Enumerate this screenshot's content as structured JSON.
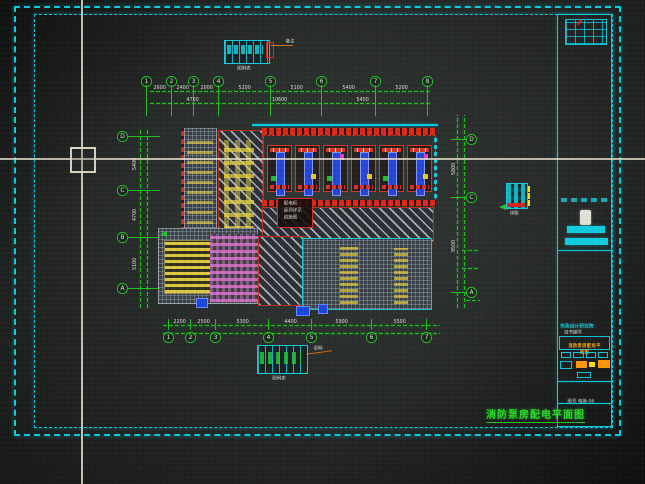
{
  "app": {
    "kind": "CAD drawing viewport photo",
    "background": "#272b29",
    "frame_color": "#00d2e6",
    "dim_color": "#1ec41e"
  },
  "drawing_title": {
    "text": "消防泵房配电平面图"
  },
  "axes": {
    "top": {
      "bubbles": [
        "1",
        "2",
        "3",
        "4",
        "5",
        "6",
        "7",
        "8"
      ],
      "dims": [
        "2600",
        "2400",
        "2000",
        "5200",
        "5100",
        "5400",
        "5200"
      ],
      "dims2": [
        "4700",
        "10600",
        "5400"
      ]
    },
    "bottom": {
      "bubbles": [
        "1",
        "2",
        "3",
        "4",
        "5",
        "6",
        "7"
      ],
      "dims": [
        "2200",
        "2500",
        "5300",
        "4400",
        "5900",
        "5500"
      ]
    },
    "left": {
      "bubbles": [
        "D",
        "C",
        "B",
        "A"
      ],
      "dims": [
        "5400",
        "4700",
        "5100"
      ]
    },
    "right": {
      "bubbles": [
        "D",
        "C",
        "A"
      ],
      "dims": [
        "5800",
        "9500"
      ]
    }
  },
  "plan": {
    "equipment_bays": 6,
    "note_box_lines": [
      "配电柜",
      "留洞详见",
      "结施图"
    ]
  },
  "legends": {
    "top": {
      "label": "图例表",
      "note": "备注"
    },
    "bottom": {
      "label": "图例表",
      "note": "说明"
    },
    "detail": {
      "label": "详图"
    }
  },
  "title_block": {
    "firm": "市政设计研究院",
    "cert": "证书编号",
    "rows": [
      {
        "label": "审定",
        "value": "2016",
        "color": "#20e020"
      },
      {
        "label": "审核",
        "value": "初设",
        "color": "#ff30ff"
      },
      {
        "label": "总工",
        "value": "施工",
        "color": "#ff30ff"
      },
      {
        "label": "校对",
        "value": "电气",
        "color": "#ff30ff"
      },
      {
        "label": "设计",
        "value": "P06",
        "color": "#ff30ff"
      },
      {
        "label": "制图",
        "value": "A2",
        "color": "#ff30ff"
      },
      {
        "label": "日期",
        "value": "1:100",
        "color": "#ff30ff"
      }
    ],
    "sheet_name": "消防泵房配电平面图",
    "footer": "图号 电施-06"
  }
}
